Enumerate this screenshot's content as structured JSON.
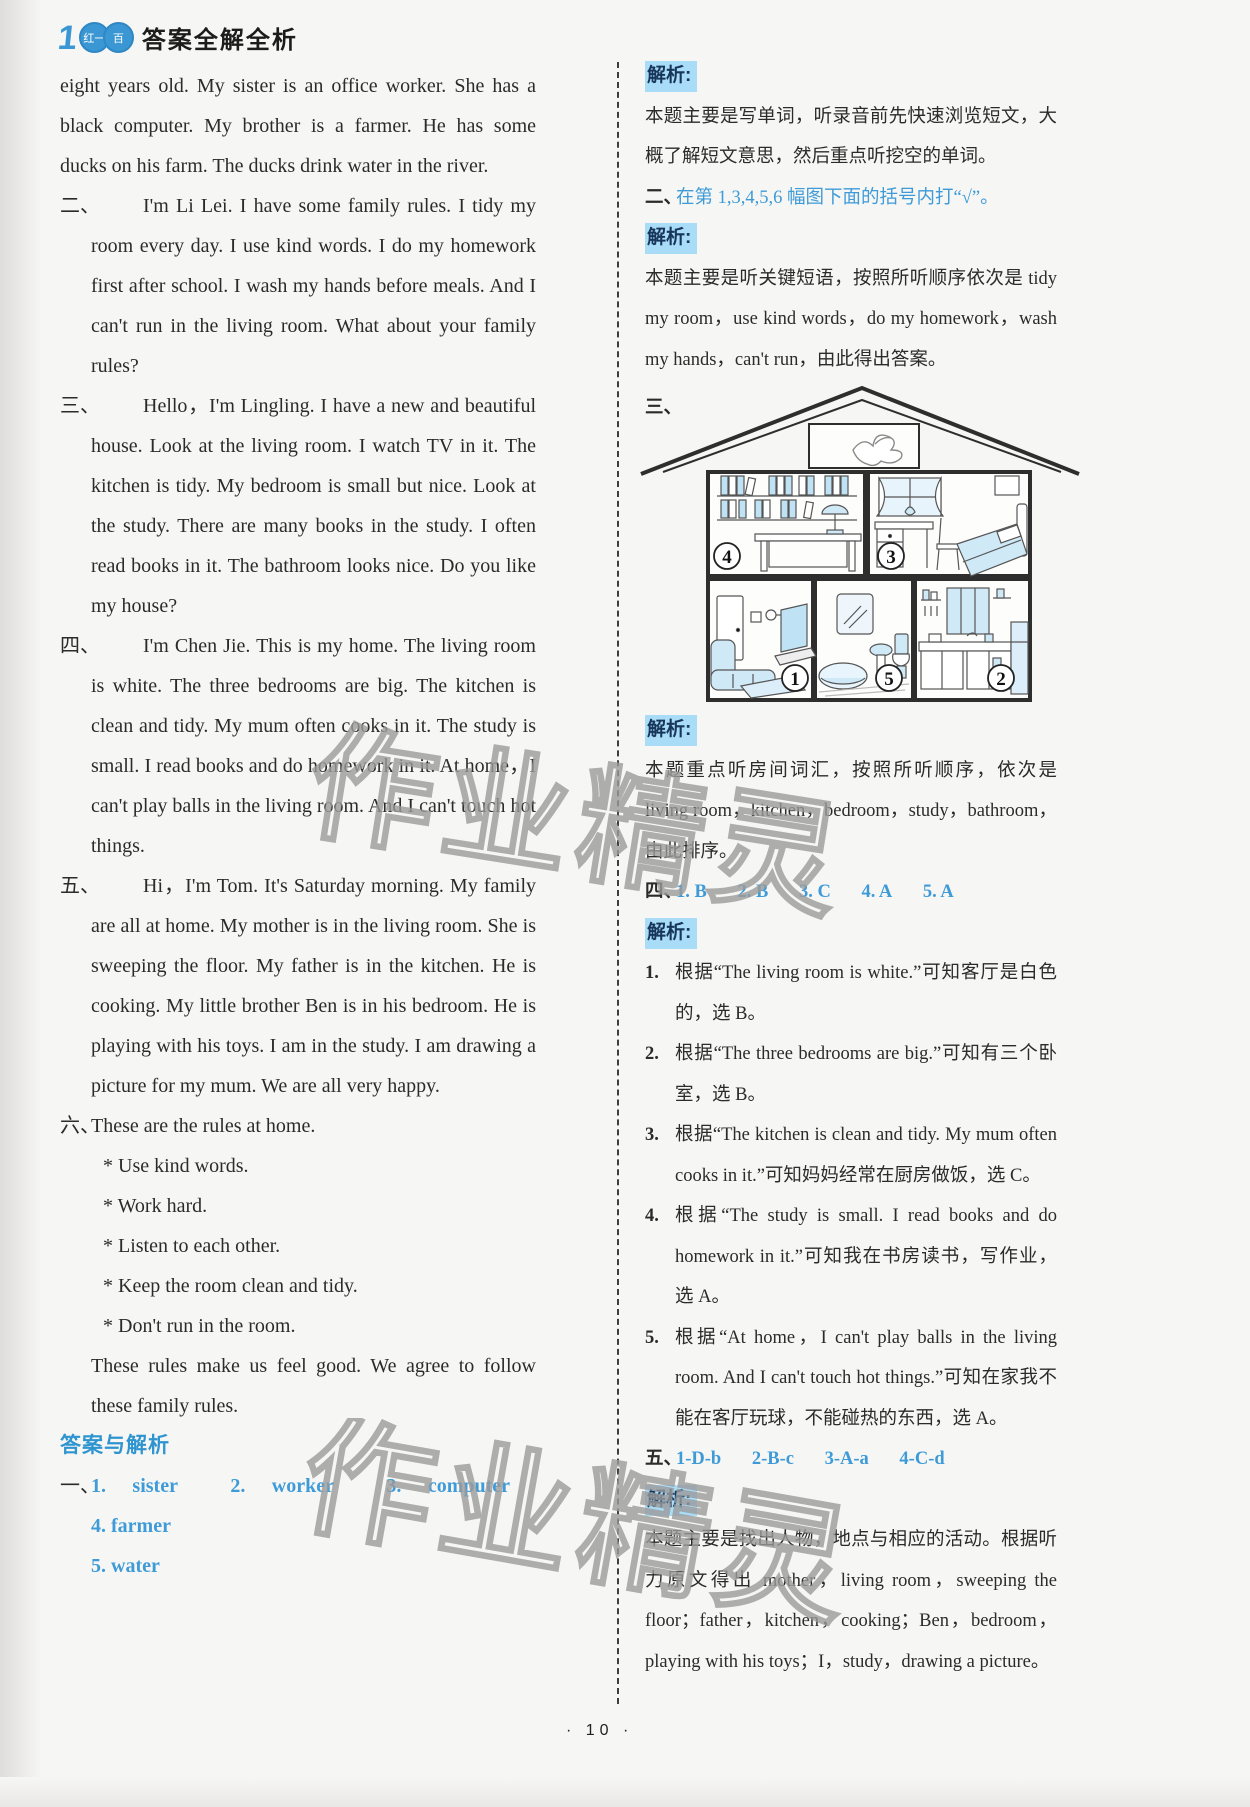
{
  "colors": {
    "accent_blue": "#3b97d3",
    "answer_blue": "#3f9bd8",
    "highlight_bg": "#a9dcf6",
    "watermark_gray": "#9b9b9b"
  },
  "header": {
    "logo_number": "1",
    "logo_ring1_text": "红一",
    "logo_ring2_text": "百",
    "title": "答案全解全析"
  },
  "watermark_text": "作业精灵",
  "footer": {
    "page_number": "· 10 ·"
  },
  "left_column": {
    "intro_text": "eight years old. My sister is an office worker. She has a black computer. My brother is a farmer. He has some ducks on his farm. The ducks drink water in the river.",
    "sections": [
      {
        "marker": "二、",
        "text": "I'm Li Lei. I have some family rules. I tidy my room every day. I use kind words. I do my homework first after school. I wash my hands before meals. And I can't run in the living room. What about your family rules?"
      },
      {
        "marker": "三、",
        "text": "Hello，I'm Lingling. I have a new and beautiful house. Look at the living room. I watch TV in it. The kitchen is tidy. My bedroom is small but nice. Look at the study. There are many books in the study. I often read books in it. The bathroom looks nice. Do you like my house?"
      },
      {
        "marker": "四、",
        "text": "I'm Chen Jie. This is my home. The living room is white. The three bedrooms are big. The kitchen is clean and tidy. My mum often cooks in it. The study is small. I read books and do homework in it. At home，I can't play balls in the living room. And I can't touch hot things."
      },
      {
        "marker": "五、",
        "text": "Hi，I'm Tom. It's Saturday morning. My family are all at home. My mother is in the living room. She is sweeping the floor. My father is in the kitchen. He is cooking. My little brother Ben is in his bedroom. He is playing with his toys. I am in the study. I am drawing a picture for my mum. We are all very happy."
      }
    ],
    "rules_section": {
      "marker": "六、",
      "intro": "These are the rules at home.",
      "rules": [
        "* Use kind words.",
        "* Work hard.",
        "* Listen to each other.",
        "* Keep the room clean and tidy.",
        "* Don't run in the room."
      ],
      "closing": "These rules make us feel good. We agree to follow these family rules."
    },
    "answers_heading": "答案与解析",
    "section_one": {
      "marker": "一、",
      "answers_line1": [
        "1. sister",
        "2. worker",
        "3. computer",
        "4. farmer"
      ],
      "answers_line2": "5. water"
    }
  },
  "right_column": {
    "analysis_label": "解析:",
    "block1_text": "本题主要是写单词，听录音前先快速浏览短文，大概了解短文意思，然后重点听挖空的单词。",
    "section_two": {
      "marker": "二、",
      "instruction": "在第 1,3,4,5,6 幅图下面的括号内打“√”。"
    },
    "block2_text": "本题主要是听关键短语，按照所听顺序依次是 tidy my room，use kind words，do my homework，wash my hands，can't run，由此得出答案。",
    "section_three": {
      "marker": "三、"
    },
    "block3_text": "本题重点听房间词汇，按照所听顺序，依次是 living room，kitchen，bedroom，study，bathroom，由此排序。",
    "section_four": {
      "marker": "四、",
      "answers": [
        "1. B",
        "2. B",
        "3. C",
        "4. A",
        "5. A"
      ]
    },
    "block4_items": [
      {
        "num": "1.",
        "text": "根据“The living room is white.”可知客厅是白色的，选 B。"
      },
      {
        "num": "2.",
        "text": "根据“The three bedrooms are big.”可知有三个卧室，选 B。"
      },
      {
        "num": "3.",
        "text": "根据“The kitchen is clean and tidy. My mum often cooks in it.”可知妈妈经常在厨房做饭，选 C。"
      },
      {
        "num": "4.",
        "text": "根据“The study is small. I read books and do homework in it.”可知我在书房读书，写作业，选 A。"
      },
      {
        "num": "5.",
        "text": "根据“At home，I can't play balls in the living room. And I can't touch hot things.”可知在家我不能在客厅玩球，不能碰热的东西，选 A。"
      }
    ],
    "section_five": {
      "marker": "五、",
      "answers": [
        "1-D-b",
        "2-B-c",
        "3-A-a",
        "4-C-d"
      ]
    },
    "block5_text": "本题主要是找出人物，地点与相应的活动。根据听力原文得出 mother，living room，sweeping the floor；father，kitchen，cooking；Ben，bedroom，playing with his toys；I，study，drawing a picture。"
  },
  "house": {
    "rooms": [
      {
        "id": "study",
        "number": "4"
      },
      {
        "id": "bedroom",
        "number": "3"
      },
      {
        "id": "living-room",
        "number": "1"
      },
      {
        "id": "bathroom",
        "number": "5"
      },
      {
        "id": "kitchen",
        "number": "2"
      }
    ]
  }
}
